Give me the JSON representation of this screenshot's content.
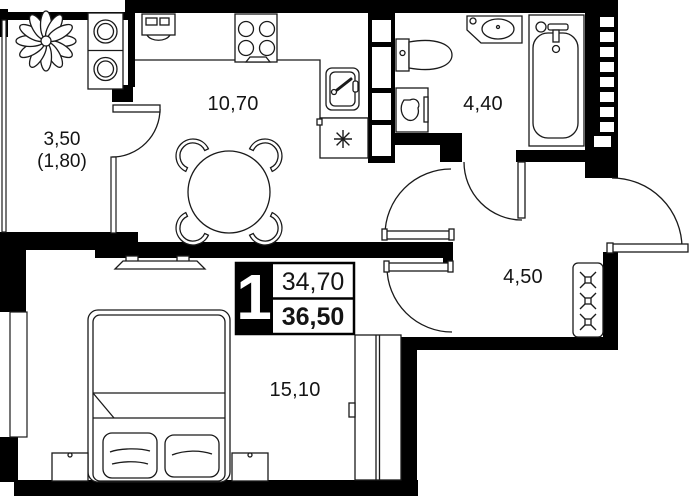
{
  "floor_plan": {
    "apartment_card": {
      "rooms_count": "1",
      "living_area": "34,70",
      "total_area": "36,50"
    },
    "room_labels": {
      "balcony_area": "3,50",
      "balcony_area_reduced": "(1,80)",
      "kitchen_living_area": "10,70",
      "bathroom_area": "4,40",
      "hallway_area": "4,50",
      "bedroom_area": "15,10"
    },
    "legend": {
      "icons": [
        "plant-icon",
        "washer-dryer-icon",
        "stove-icon",
        "kitchen-sink-icon",
        "fridge-icon",
        "dining-table-icon",
        "toilet-icon",
        "wash-basin-icon",
        "bathtub-icon",
        "laundry-cabinet-icon",
        "hallway-wardrobe-icon",
        "bedroom-wardrobe-icon",
        "tv-icon",
        "bed-icon",
        "nightstand-icon"
      ]
    },
    "colors": {
      "walls": "#000000",
      "background": "#ffffff",
      "lines": "#1a1a1a"
    }
  }
}
